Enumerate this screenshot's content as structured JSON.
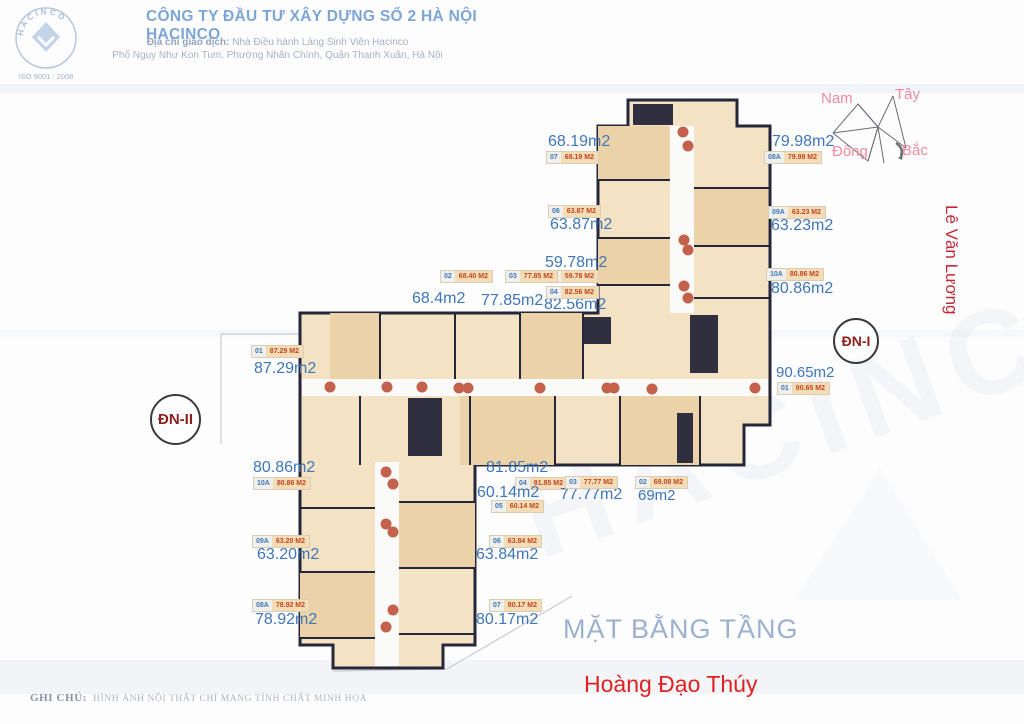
{
  "header": {
    "title": "CÔNG TY ĐẦU TƯ XÂY DỰNG SỐ 2 HÀ NỘI  HACINCO",
    "address_label": "Địa chỉ giao dịch:",
    "address_rest": " Nhà Điều hành Làng Sinh Viên Hacinco",
    "address_line2": "Phố Ngụy Như Kon Tum, Phường Nhân Chính, Quận Thanh Xuân, Hà Nội",
    "logo_text": "HACINCO",
    "logo_iso": "ISO 9001 : 2008"
  },
  "compass": {
    "south": "Nam",
    "west": "Tây",
    "east": "Đông",
    "north": "Bắc"
  },
  "streets": {
    "right": "Lê Văn Lương",
    "bottom": "Hoàng Đạo Thúy"
  },
  "plan_title": "MẶT BẰNG TẦNG",
  "entrances": {
    "dn1": "ĐN-I",
    "dn2": "ĐN-II"
  },
  "watermark": "HACINCO",
  "footer": {
    "label": "GHI CHÚ:",
    "text": "HÌNH ẢNH NỘI THẤT CHỈ MANG TÍNH CHẤT MINH HỌA"
  },
  "colors": {
    "label_blue": "#3f76b8",
    "tag_red": "#c2441f",
    "tag_tan": "#f4ddb6",
    "plan_fill": "#f4e2c4",
    "wall": "#26263a",
    "dot": "#c4614d",
    "street_red": "#c52836",
    "compass_pink": "#f08aa0",
    "title_gray_blue": "#9cb1cf"
  },
  "apartments": [
    {
      "unit": "07",
      "area": "68.19m2",
      "tag_area": "68.19 M2",
      "big": {
        "x": 548,
        "y": 134
      },
      "tag": {
        "x": 546,
        "y": 151
      }
    },
    {
      "unit": "06",
      "area": "63.87m2",
      "tag_area": "63.87 M2",
      "big": {
        "x": 550,
        "y": 217
      },
      "tag": {
        "x": 548,
        "y": 205
      }
    },
    {
      "unit": "05",
      "area": "59.78m2",
      "tag_area": "59.78 M2",
      "big": {
        "x": 545,
        "y": 255
      },
      "tag": {
        "x": 546,
        "y": 270
      }
    },
    {
      "unit": "04",
      "area": "82.56m2",
      "tag_area": "82.56 M2",
      "big": {
        "x": 544,
        "y": 297
      },
      "tag": {
        "x": 546,
        "y": 286
      }
    },
    {
      "unit": "08A",
      "area": "79.98m2",
      "tag_area": "79.98 M2",
      "big": {
        "x": 772,
        "y": 134
      },
      "tag": {
        "x": 764,
        "y": 151
      }
    },
    {
      "unit": "09A",
      "area": "63.23m2",
      "tag_area": "63.23 M2",
      "big": {
        "x": 771,
        "y": 218
      },
      "tag": {
        "x": 768,
        "y": 206
      }
    },
    {
      "unit": "10A",
      "area": "80.86m2",
      "tag_area": "80.86 M2",
      "big": {
        "x": 771,
        "y": 281
      },
      "tag": {
        "x": 766,
        "y": 268
      }
    },
    {
      "unit": "02",
      "area": "68.4m2",
      "tag_area": "68.40 M2",
      "big": {
        "x": 412,
        "y": 291
      },
      "tag": {
        "x": 440,
        "y": 270
      }
    },
    {
      "unit": "03",
      "area": "77.85m2",
      "tag_area": "77.85 M2",
      "big": {
        "x": 481,
        "y": 293
      },
      "tag": {
        "x": 505,
        "y": 270
      }
    },
    {
      "unit": "01",
      "area": "87.29m2",
      "tag_area": "87.29 M2",
      "big": {
        "x": 254,
        "y": 361
      },
      "tag": {
        "x": 251,
        "y": 345
      }
    },
    {
      "unit": "01",
      "area": "90.65m2",
      "tag_area": "90.65 M2",
      "big": {
        "x": 776,
        "y": 365,
        "size": 15
      },
      "tag": {
        "x": 777,
        "y": 382
      }
    },
    {
      "unit": "10A",
      "area": "80.86m2",
      "tag_area": "80.86 M2",
      "big": {
        "x": 253,
        "y": 460
      },
      "tag": {
        "x": 253,
        "y": 477
      }
    },
    {
      "unit": "09A",
      "area": "63.20m2",
      "tag_area": "63.20 M2",
      "big": {
        "x": 257,
        "y": 547
      },
      "tag": {
        "x": 252,
        "y": 535
      }
    },
    {
      "unit": "08A",
      "area": "78.92m2",
      "tag_area": "78.92 M2",
      "big": {
        "x": 255,
        "y": 612
      },
      "tag": {
        "x": 252,
        "y": 599
      }
    },
    {
      "unit": "04",
      "area": "81.85m2",
      "tag_area": "81.85 M2",
      "big": {
        "x": 486,
        "y": 460
      },
      "tag": {
        "x": 515,
        "y": 477
      }
    },
    {
      "unit": "05",
      "area": "60.14m2",
      "tag_area": "60.14 M2",
      "big": {
        "x": 477,
        "y": 485
      },
      "tag": {
        "x": 491,
        "y": 500
      }
    },
    {
      "unit": "03",
      "area": "77.77m2",
      "tag_area": "77.77 M2",
      "big": {
        "x": 560,
        "y": 487
      },
      "tag": {
        "x": 565,
        "y": 476
      }
    },
    {
      "unit": "02",
      "area": "69m2",
      "tag_area": "69.08 M2",
      "big": {
        "x": 638,
        "y": 488,
        "size": 15
      },
      "tag": {
        "x": 635,
        "y": 476
      }
    },
    {
      "unit": "06",
      "area": "63.84m2",
      "tag_area": "63.84 M2",
      "big": {
        "x": 476,
        "y": 547
      },
      "tag": {
        "x": 489,
        "y": 535
      }
    },
    {
      "unit": "07",
      "area": "80.17m2",
      "tag_area": "80.17 M2",
      "big": {
        "x": 476,
        "y": 612
      },
      "tag": {
        "x": 489,
        "y": 599
      }
    }
  ]
}
